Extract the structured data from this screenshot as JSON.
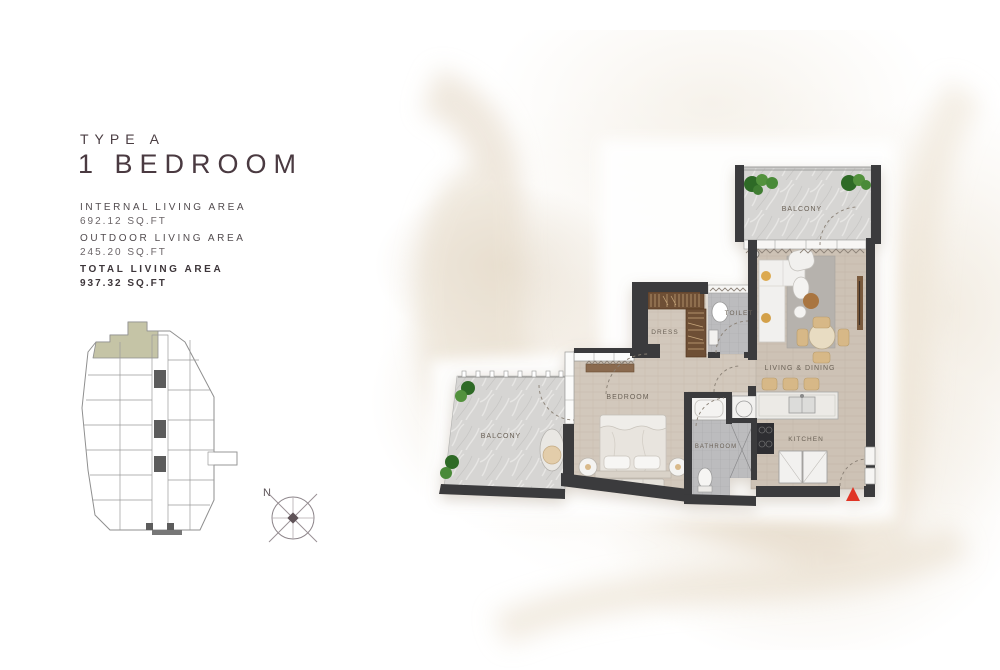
{
  "panel": {
    "type_label": "TYPE A",
    "title": "1 BEDROOM",
    "areas": [
      {
        "label": "INTERNAL LIVING AREA",
        "value": "692.12 SQ.FT"
      },
      {
        "label": "OUTDOOR LIVING AREA",
        "value": "245.20 SQ.FT"
      },
      {
        "label": "TOTAL LIVING AREA",
        "value": "937.32 SQ.FT"
      }
    ]
  },
  "keyplan": {
    "highlight_color": "#c5c4a6"
  },
  "compass": {
    "north_label": "N"
  },
  "floorplan": {
    "rooms": {
      "balcony_top": "BALCONY",
      "living_dining": "LIVING & DINING",
      "dress": "DRESS",
      "toilet": "TOILET",
      "bedroom": "BEDROOM",
      "bathroom": "BATHROOM",
      "kitchen": "KITCHEN",
      "balcony_bottom": "BALCONY"
    },
    "colors": {
      "wall": "#3a3a3c",
      "wood_floor": "#cdc2b5",
      "marble_floor": "#d8d7d5",
      "tile_floor": "#bdbdbf",
      "wardrobe": "#6e4f36",
      "plant": "#3c8231",
      "entry_arrow": "#e03428"
    }
  }
}
